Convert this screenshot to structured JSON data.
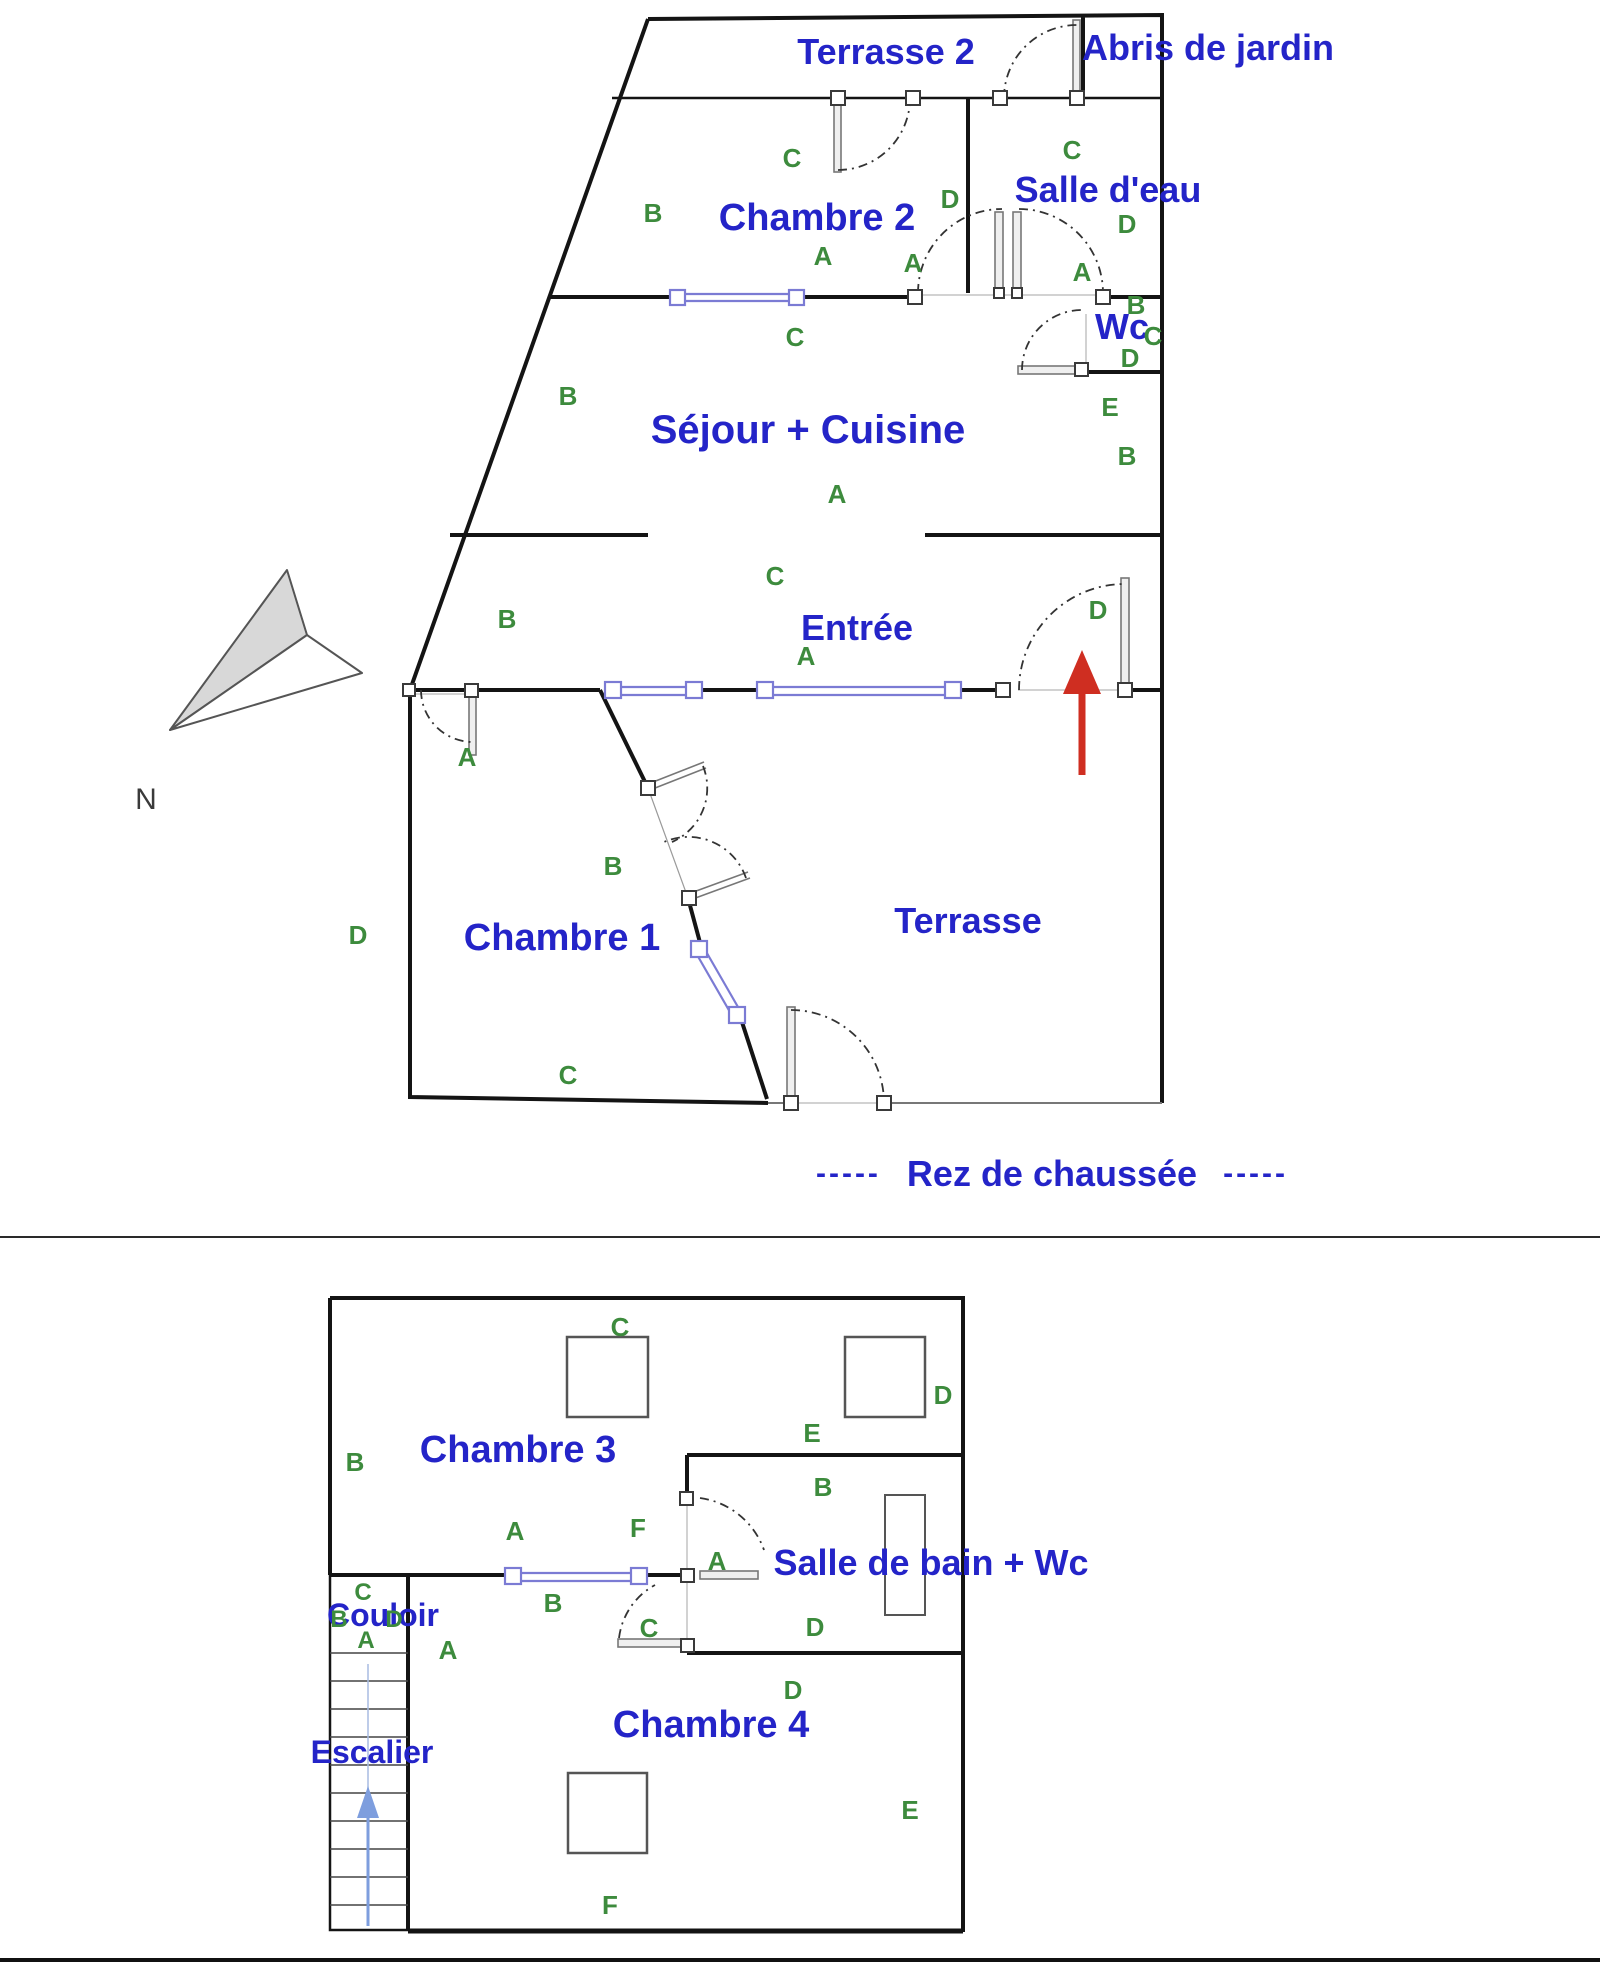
{
  "document": {
    "type": "floor-plan",
    "levels": 2
  },
  "colors": {
    "wall": "#141414",
    "room_label": "#2424c8",
    "wall_marker": "#3d8b3d",
    "window": "#7b7bd4",
    "door_leaf": "#777777",
    "entry_arrow": "#cf2e21",
    "stair_arrow": "#7e9ede",
    "compass_fill": "#d8d8d8"
  },
  "ground_floor": {
    "caption": {
      "left_dashes": "-----",
      "title": "Rez de chaussée",
      "right_dashes": "-----"
    },
    "compass_label": "N",
    "rooms": [
      {
        "name": "Terrasse 2"
      },
      {
        "name": "Abris de jardin"
      },
      {
        "name": "Chambre 2"
      },
      {
        "name": "Salle d'eau"
      },
      {
        "name": "Wc"
      },
      {
        "name": "Séjour + Cuisine"
      },
      {
        "name": "Entrée"
      },
      {
        "name": "Chambre 1"
      },
      {
        "name": "Terrasse"
      }
    ],
    "labels": [
      {
        "t": "C"
      },
      {
        "t": "B"
      },
      {
        "t": "A"
      },
      {
        "t": "D"
      },
      {
        "t": "C"
      },
      {
        "t": "D"
      },
      {
        "t": "A"
      },
      {
        "t": "B"
      },
      {
        "t": "C"
      },
      {
        "t": "D"
      },
      {
        "t": "E"
      },
      {
        "t": "B"
      },
      {
        "t": "C"
      },
      {
        "t": "B"
      },
      {
        "t": "A"
      },
      {
        "t": "C"
      },
      {
        "t": "A"
      },
      {
        "t": "B"
      },
      {
        "t": "D"
      },
      {
        "t": "A"
      },
      {
        "t": "B"
      },
      {
        "t": "D"
      },
      {
        "t": "C"
      },
      {
        "t": "A"
      }
    ]
  },
  "upper_floor": {
    "rooms": [
      {
        "name": "Chambre 3"
      },
      {
        "name": "Salle de bain + Wc"
      },
      {
        "name": "Couloir"
      },
      {
        "name": "Escalier"
      },
      {
        "name": "Chambre 4"
      }
    ],
    "labels": [
      {
        "t": "C"
      },
      {
        "t": "D"
      },
      {
        "t": "B"
      },
      {
        "t": "E"
      },
      {
        "t": "B"
      },
      {
        "t": "A"
      },
      {
        "t": "F"
      },
      {
        "t": "A"
      },
      {
        "t": "B"
      },
      {
        "t": "C"
      },
      {
        "t": "D"
      },
      {
        "t": "D"
      },
      {
        "t": "C"
      },
      {
        "t": "B"
      },
      {
        "t": "D"
      },
      {
        "t": "A"
      },
      {
        "t": "A"
      },
      {
        "t": "E"
      },
      {
        "t": "F"
      }
    ]
  }
}
